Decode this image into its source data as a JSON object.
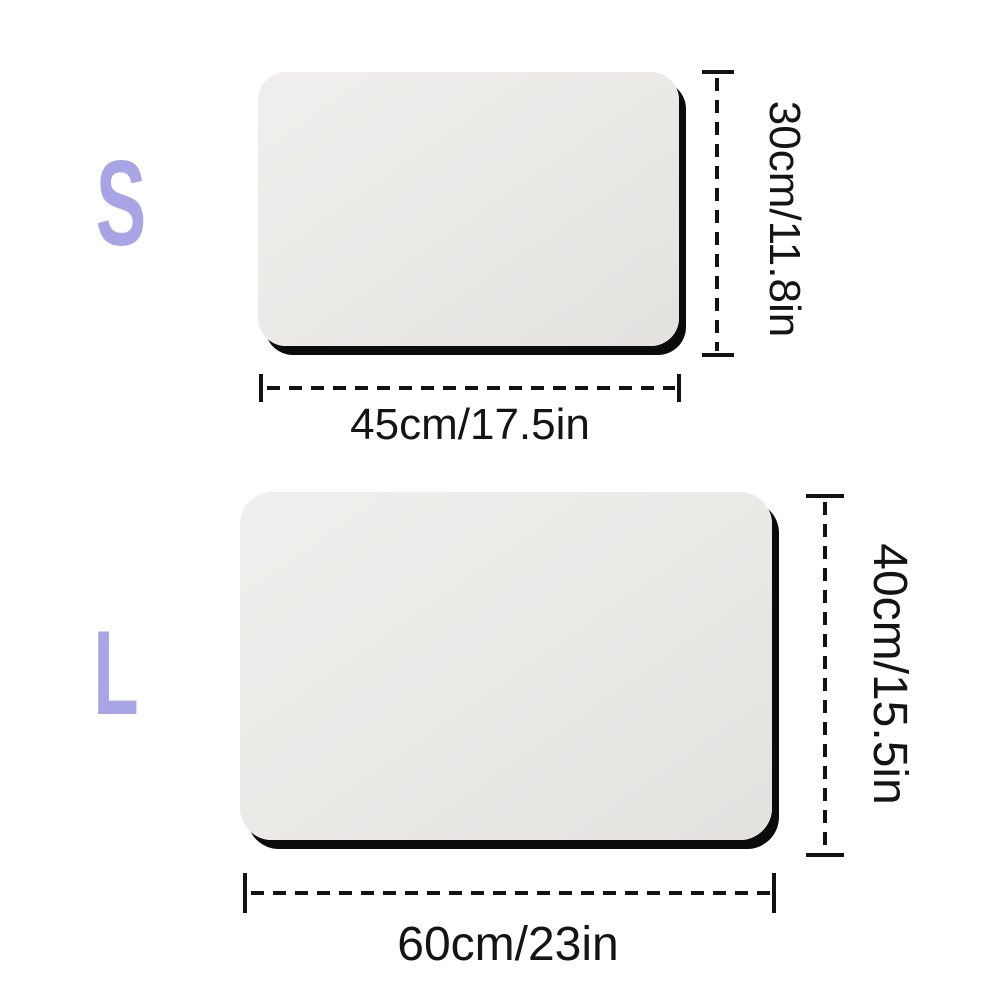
{
  "diagram_title": "mat-size-comparison",
  "colors": {
    "background": "#ffffff",
    "size_letter": "#a9a4e6",
    "dimension_line": "#121212",
    "dimension_text": "#141414",
    "mat_fill": "#ebe9e6",
    "mat_shadow": "#0b0b0b"
  },
  "sizes": [
    {
      "label": "S",
      "width_label": "45cm/17.5in",
      "height_label": "30cm/11.8in"
    },
    {
      "label": "L",
      "width_label": "60cm/23in",
      "height_label": "40cm/15.5in"
    }
  ]
}
